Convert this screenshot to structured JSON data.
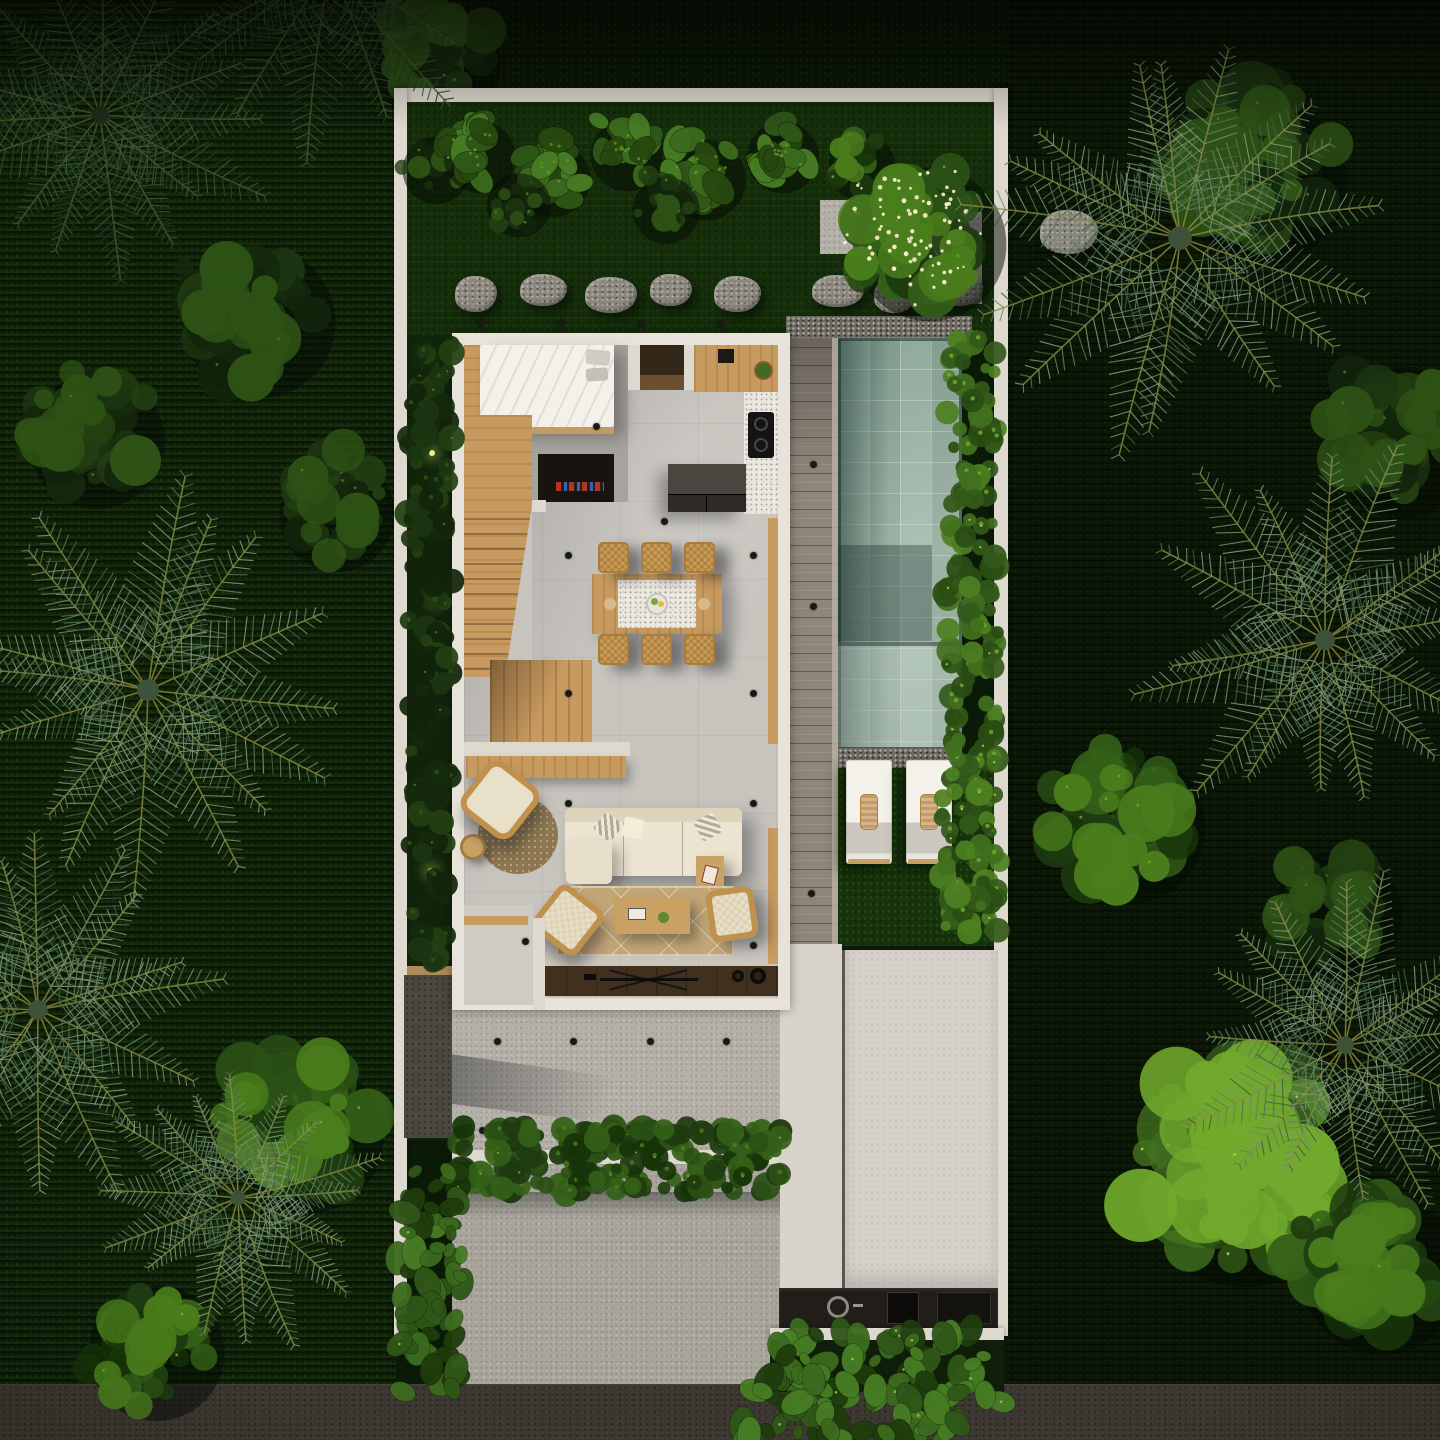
{
  "meta": {
    "label": "Aerial top-down 3D render of a tropical villa floor plan: bedroom, kitchen, dining, living room, wooden stairs, pool with deck and two sun loungers, garden with palms, terrace, driveway and street",
    "canvas": {
      "width": 1440,
      "height": 1440
    }
  },
  "palette": {
    "boundary_wall": "#ded9cf",
    "house_wall": "#e7e3da",
    "floor_gray": "#c7c4be",
    "bedroom_floor": "#a6a39e",
    "terrazzo": "#ebe8e0",
    "wood_light": "#cfa76f",
    "wood_frame": "#c29b66",
    "walnut_dark": "#3f2f20",
    "deck_gray": "#8f8679",
    "pool_light": "#a9bfb0",
    "pool_dark": "#46635c",
    "gravel": "#6e6a62",
    "terrace": "#b4b0a8",
    "driveway": "#a9a59d",
    "garage_pad": "#d5d1ca",
    "street": "#3b362f",
    "grass_garden": "#1f430f",
    "grass_outside": "#142c0c",
    "leaf_dark": "#1d3a10",
    "leaf_light": "#4c7a22",
    "rattan": "#c79a58",
    "rug": "#c1a678",
    "sofa_cream": "#ece4d0",
    "lounger_white": "#f3f1ea",
    "towel_tan": "#d7b488",
    "pool_plants": "#63951f",
    "flower_cream": "#efe7c2"
  },
  "scene": {
    "palms": [
      {
        "x": 100,
        "y": 115,
        "r": 175,
        "s": 1,
        "dark": true
      },
      {
        "x": 330,
        "y": -35,
        "r": 190,
        "s": 2,
        "dark": true
      },
      {
        "x": 148,
        "y": 690,
        "r": 218,
        "s": 3
      },
      {
        "x": 38,
        "y": 1010,
        "r": 195,
        "s": 4
      },
      {
        "x": 238,
        "y": 1198,
        "r": 150,
        "s": 5
      },
      {
        "x": 1180,
        "y": 238,
        "r": 235,
        "s": 6
      },
      {
        "x": 1325,
        "y": 640,
        "r": 200,
        "s": 7
      },
      {
        "x": 1345,
        "y": 1045,
        "r": 175,
        "s": 8
      }
    ],
    "veg_out": [
      {
        "t": "canopy",
        "x": 250,
        "y": 310,
        "r": 95,
        "tone": "dark",
        "s": 11
      },
      {
        "t": "canopy",
        "x": 88,
        "y": 430,
        "r": 85,
        "tone": "dark",
        "s": 12
      },
      {
        "t": "canopy",
        "x": 330,
        "y": 505,
        "r": 72,
        "tone": "dark",
        "s": 13
      },
      {
        "t": "canopy",
        "x": 430,
        "y": 55,
        "r": 78,
        "tone": "dark",
        "s": 14
      },
      {
        "t": "canopy",
        "x": 1252,
        "y": 168,
        "r": 105,
        "tone": "dark",
        "s": 15
      },
      {
        "t": "canopy",
        "x": 1392,
        "y": 430,
        "r": 95,
        "tone": "dark",
        "s": 16
      },
      {
        "t": "canopy",
        "x": 1120,
        "y": 815,
        "r": 95,
        "tone": "mid",
        "s": 17
      },
      {
        "t": "canopy",
        "x": 1232,
        "y": 1168,
        "r": 128,
        "tone": "light",
        "s": 18
      },
      {
        "t": "canopy",
        "x": 1372,
        "y": 1262,
        "r": 100,
        "tone": "mid",
        "s": 19
      },
      {
        "t": "canopy",
        "x": 298,
        "y": 1125,
        "r": 95,
        "tone": "mid",
        "s": 20
      },
      {
        "t": "canopy",
        "x": 148,
        "y": 1342,
        "r": 85,
        "tone": "mid",
        "s": 21
      },
      {
        "t": "canopy",
        "x": 1330,
        "y": 905,
        "r": 80,
        "tone": "dark",
        "s": 22
      }
    ],
    "veg_in": [
      {
        "t": "canopy",
        "x": 432,
        "y": 165,
        "r": 42,
        "tone": "dark",
        "s": 47
      },
      {
        "t": "taro",
        "x": 475,
        "y": 150,
        "r": 48,
        "s": 31
      },
      {
        "t": "taro",
        "x": 548,
        "y": 172,
        "r": 50,
        "s": 32
      },
      {
        "t": "taro",
        "x": 622,
        "y": 148,
        "r": 48,
        "s": 33
      },
      {
        "t": "taro",
        "x": 700,
        "y": 172,
        "r": 54,
        "s": 34
      },
      {
        "t": "taro",
        "x": 778,
        "y": 150,
        "r": 48,
        "s": 35
      },
      {
        "t": "canopy",
        "x": 515,
        "y": 200,
        "r": 40,
        "tone": "dark",
        "s": 36
      },
      {
        "t": "canopy",
        "x": 662,
        "y": 205,
        "r": 42,
        "tone": "dark",
        "s": 37
      },
      {
        "t": "canopy",
        "x": 858,
        "y": 162,
        "r": 42,
        "tone": "mid",
        "s": 39
      },
      {
        "t": "frangipani",
        "x": 920,
        "y": 232,
        "r": 96,
        "s": 38
      },
      {
        "t": "bushline",
        "x": 946,
        "y": 338,
        "w": 52,
        "h": 444,
        "s": 40
      },
      {
        "t": "bushline",
        "x": 942,
        "y": 782,
        "w": 58,
        "h": 160,
        "s": 41
      },
      {
        "t": "bushline",
        "x": 408,
        "y": 340,
        "w": 44,
        "h": 625,
        "dark": true,
        "s": 46
      },
      {
        "t": "hedge",
        "x": 452,
        "y": 1126,
        "w": 330,
        "h": 68,
        "s": 42
      },
      {
        "t": "taroline",
        "x": 772,
        "y": 1330,
        "w": 230,
        "h": 72,
        "s": 43
      },
      {
        "t": "taroline",
        "x": 396,
        "y": 1168,
        "w": 66,
        "h": 224,
        "s": 44
      },
      {
        "t": "taroline",
        "x": 740,
        "y": 1378,
        "w": 234,
        "h": 62,
        "s": 45
      }
    ],
    "stones": [
      {
        "x": 455,
        "y": 276
      },
      {
        "x": 520,
        "y": 274
      },
      {
        "x": 585,
        "y": 277
      },
      {
        "x": 650,
        "y": 274
      },
      {
        "x": 714,
        "y": 276
      },
      {
        "x": 812,
        "y": 275
      },
      {
        "x": 874,
        "y": 277
      },
      {
        "x": 936,
        "y": 274
      },
      {
        "x": 1040,
        "y": 210,
        "w": 58,
        "h": 44
      }
    ],
    "pads": [
      {
        "x": 820,
        "y": 200,
        "w": 54,
        "h": 54
      },
      {
        "x": 884,
        "y": 212,
        "w": 98,
        "h": 92
      }
    ],
    "garden_dots": [
      [
        477,
        320
      ],
      [
        557,
        320
      ],
      [
        637,
        320
      ],
      [
        717,
        320
      ]
    ],
    "deck_dots": [
      [
        810,
        461
      ],
      [
        810,
        603
      ],
      [
        808,
        890
      ]
    ],
    "ceiling_dots": [
      [
        565,
        552
      ],
      [
        750,
        552
      ],
      [
        565,
        690
      ],
      [
        750,
        690
      ],
      [
        565,
        800
      ],
      [
        750,
        800
      ],
      [
        750,
        942
      ],
      [
        593,
        423
      ],
      [
        661,
        518
      ],
      [
        522,
        938
      ]
    ],
    "terrace_dots": [
      [
        494,
        1038
      ],
      [
        570,
        1038
      ],
      [
        647,
        1038
      ],
      [
        723,
        1038
      ],
      [
        479,
        1127
      ],
      [
        556,
        1127
      ],
      [
        634,
        1127
      ],
      [
        712,
        1127
      ]
    ],
    "big_dots": [
      [
        460,
        1124
      ]
    ],
    "uplights": [
      [
        429,
        450
      ],
      [
        432,
        596
      ],
      [
        428,
        868
      ]
    ],
    "dining_chairs": {
      "xs": [
        598,
        641,
        684
      ],
      "top_y": 542,
      "bottom_y": 634,
      "size": 31
    },
    "loungers": [
      {
        "x": 846,
        "y": 760
      },
      {
        "x": 906,
        "y": 760
      }
    ]
  }
}
